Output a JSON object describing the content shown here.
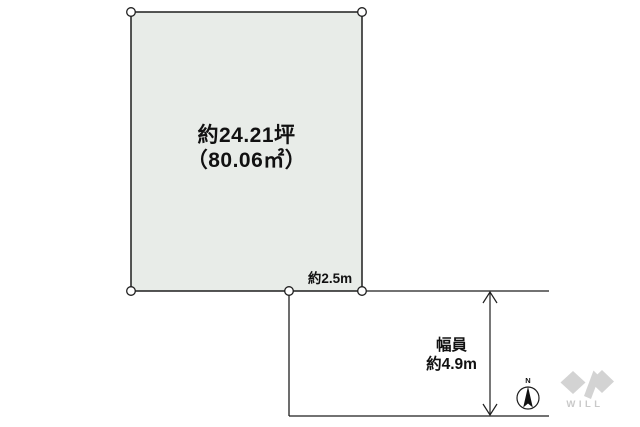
{
  "diagram": {
    "parcel": {
      "area_line1": "約24.21坪",
      "area_line2": "（80.06㎡）",
      "frontage_label": "約2.5m",
      "fill_color": "#e8ece8"
    },
    "road": {
      "width_label_line1": "幅員",
      "width_label_line2": "約4.9m"
    },
    "compass": {
      "north_label": "N"
    },
    "logo": {
      "text": "WILL",
      "color": "#d3d3d3"
    }
  }
}
